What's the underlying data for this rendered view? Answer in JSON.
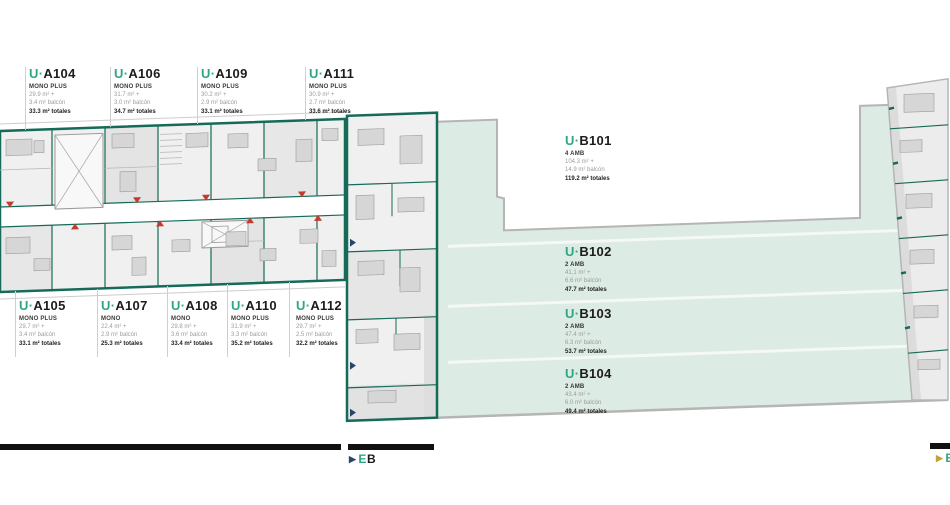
{
  "labels": {
    "prefix": "U·"
  },
  "units": {
    "top": [
      {
        "code": "A104",
        "type": "MONO PLUS",
        "area": "29.9 m² +",
        "balcony": "3.4 m² balcón",
        "total": "33.3 m² totales"
      },
      {
        "code": "A106",
        "type": "MONO PLUS",
        "area": "31.7 m² +",
        "balcony": "3.0 m² balcón",
        "total": "34.7 m² totales"
      },
      {
        "code": "A109",
        "type": "MONO PLUS",
        "area": "30.2 m² +",
        "balcony": "2.9 m² balcón",
        "total": "33.1 m² totales"
      },
      {
        "code": "A111",
        "type": "MONO PLUS",
        "area": "30.9 m² +",
        "balcony": "2.7 m² balcón",
        "total": "33.6 m² totales"
      }
    ],
    "bottom": [
      {
        "code": "A105",
        "type": "MONO PLUS",
        "area": "29.7 m² +",
        "balcony": "3.4 m² balcón",
        "total": "33.1 m² totales"
      },
      {
        "code": "A107",
        "type": "MONO",
        "area": "22.4 m² +",
        "balcony": "2.9 m² balcón",
        "total": "25.3 m² totales"
      },
      {
        "code": "A108",
        "type": "MONO",
        "area": "29.8 m² +",
        "balcony": "3.6 m² balcón",
        "total": "33.4 m² totales"
      },
      {
        "code": "A110",
        "type": "MONO PLUS",
        "area": "31.9 m² +",
        "balcony": "3.3 m² balcón",
        "total": "35.2 m² totales"
      },
      {
        "code": "A112",
        "type": "MONO PLUS",
        "area": "29.7 m² +",
        "balcony": "2.5 m² balcón",
        "total": "32.2 m² totales"
      }
    ],
    "b_column": [
      {
        "code": "B101",
        "type": "4 AMB",
        "area": "104.3 m² +",
        "balcony": "14.9 m² balcón",
        "total": "119.2 m² totales"
      },
      {
        "code": "B102",
        "type": "2 AMB",
        "area": "41.1 m² +",
        "balcony": "6.6 m² balcón",
        "total": "47.7 m² totales"
      },
      {
        "code": "B103",
        "type": "2 AMB",
        "area": "47.4 m² +",
        "balcony": "6.3 m² balcón",
        "total": "53.7 m² totales"
      },
      {
        "code": "B104",
        "type": "2 AMB",
        "area": "43.4 m² +",
        "balcony": "6.0 m² balcón",
        "total": "49.4 m² totales"
      }
    ]
  },
  "markers": {
    "eb_arrow": "▶",
    "eb_accent": "E",
    "eb_dark": "B",
    "right_arrow": "▶",
    "right_accent": "E"
  },
  "colors": {
    "wall_teal": "#166a58",
    "accent_teal": "#2ea786",
    "terrace_mint": "#dcebe4",
    "outline_gray": "#b5b5b5",
    "entry_red": "#c43c30",
    "marker_navy": "#27466e"
  }
}
